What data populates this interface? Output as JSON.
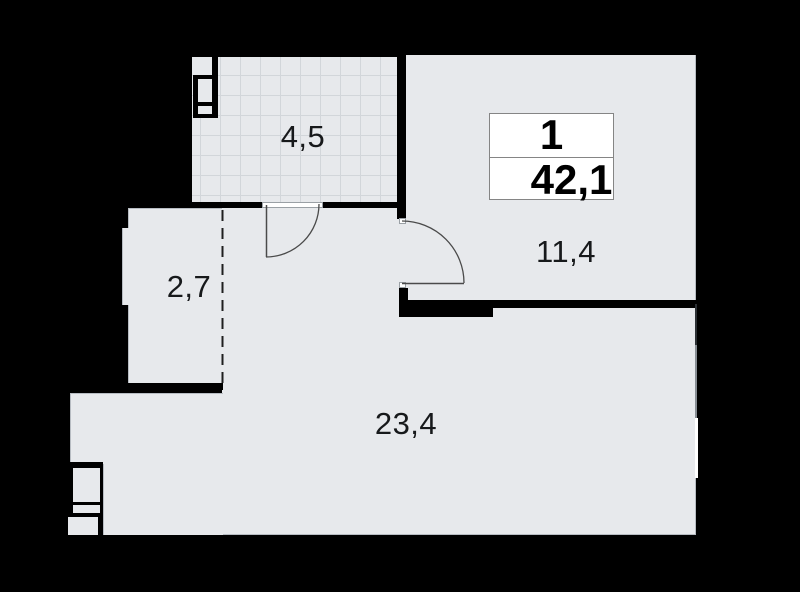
{
  "plan": {
    "apartment": {
      "rooms_count": "1",
      "total_area": "42,1"
    },
    "rooms": [
      {
        "id": "bathroom",
        "area": "4,5"
      },
      {
        "id": "hall",
        "area": "2,7"
      },
      {
        "id": "bedroom",
        "area": "11,4"
      },
      {
        "id": "living-kitchen",
        "area": "23,4"
      }
    ],
    "colors": {
      "background": "#000000",
      "floor": "#e7e9ec",
      "tile_grid": "#d2d6da",
      "wall": "#000000",
      "window_glass": "#ffffff",
      "window_frame": "#878d93",
      "door_line": "#4a4a4a",
      "label_text": "#17191b",
      "info_box_border": "#858585"
    }
  }
}
